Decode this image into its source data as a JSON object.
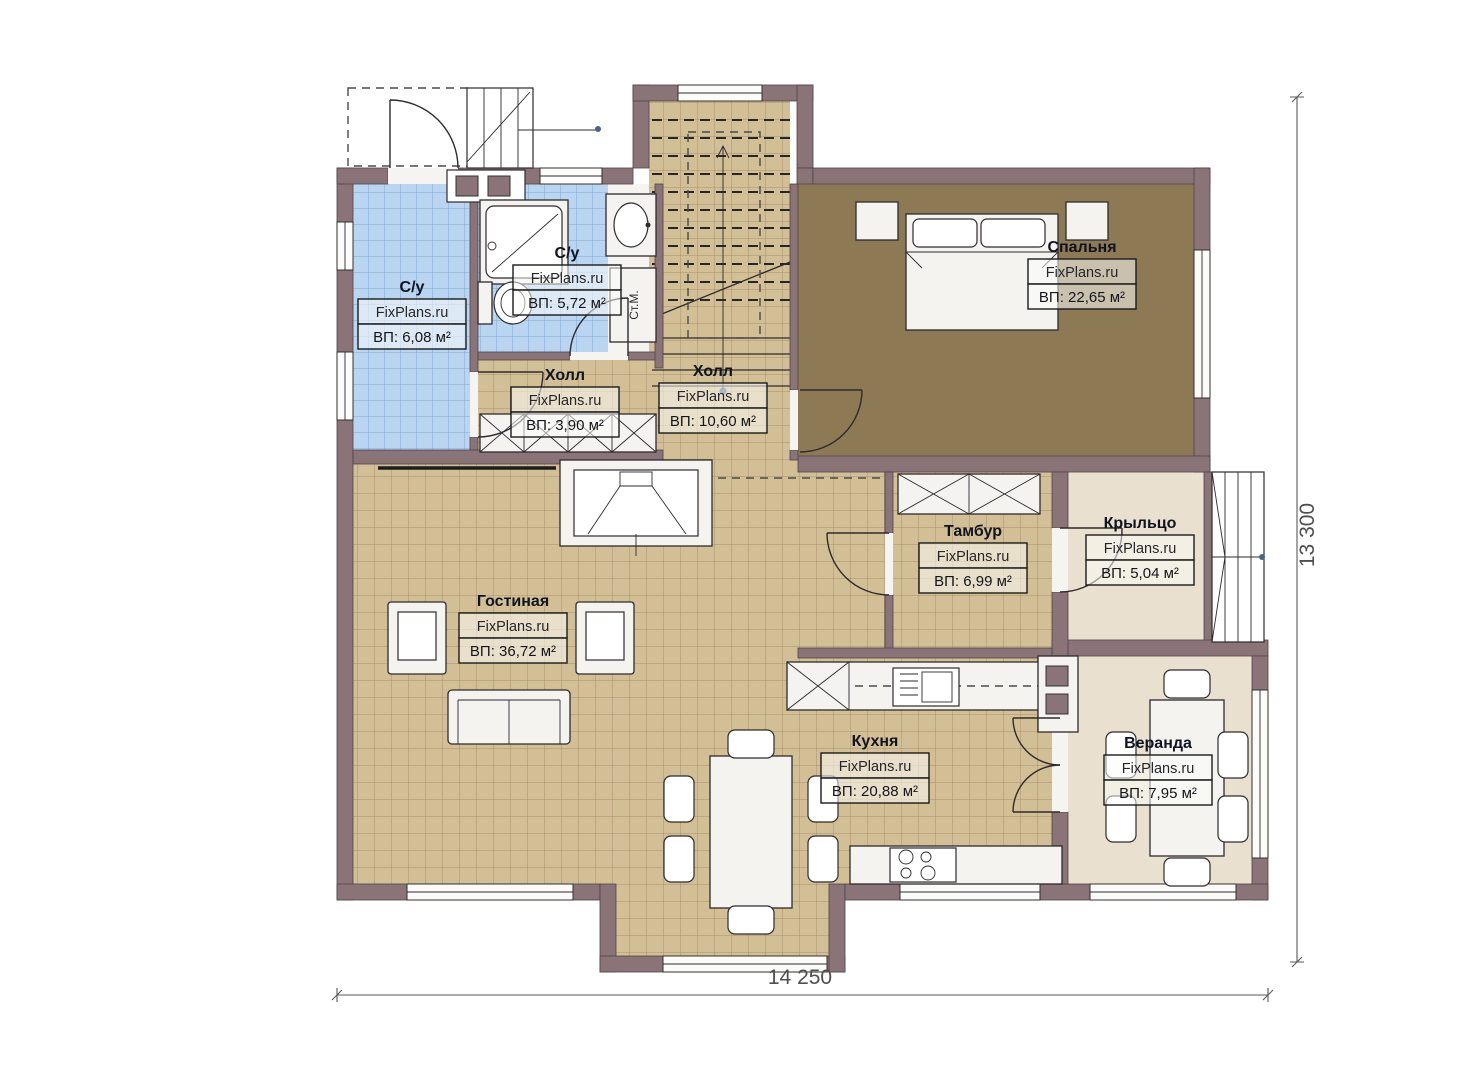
{
  "plan": {
    "watermark": "FixPlans.ru",
    "rooms": [
      {
        "name": "С/у",
        "area": "ВП: 6,08 м²"
      },
      {
        "name": "С/у",
        "area": "ВП: 5,72 м²"
      },
      {
        "name": "Холл",
        "area": "ВП: 3,90 м²"
      },
      {
        "name": "Холл",
        "area": "ВП: 10,60 м²"
      },
      {
        "name": "Спальня",
        "area": "ВП: 22,65 м²"
      },
      {
        "name": "Гостиная",
        "area": "ВП: 36,72 м²"
      },
      {
        "name": "Тамбур",
        "area": "ВП: 6,99 м²"
      },
      {
        "name": "Крыльцо",
        "area": "ВП: 5,04 м²"
      },
      {
        "name": "Кухня",
        "area": "ВП: 20,88 м²"
      },
      {
        "name": "Веранда",
        "area": "ВП: 7,95 м²"
      }
    ],
    "annotations": {
      "washing_machine": "Ст.М."
    },
    "dimensions": {
      "width_mm": "14 250",
      "height_mm": "13 300"
    },
    "colors": {
      "wall": "#8a7478",
      "floor_tile_beige": "#d3bf96",
      "floor_tile_blue": "#b9d5f1",
      "floor_bedroom": "#8d7a55",
      "floor_cream": "#e9e0cf"
    }
  }
}
